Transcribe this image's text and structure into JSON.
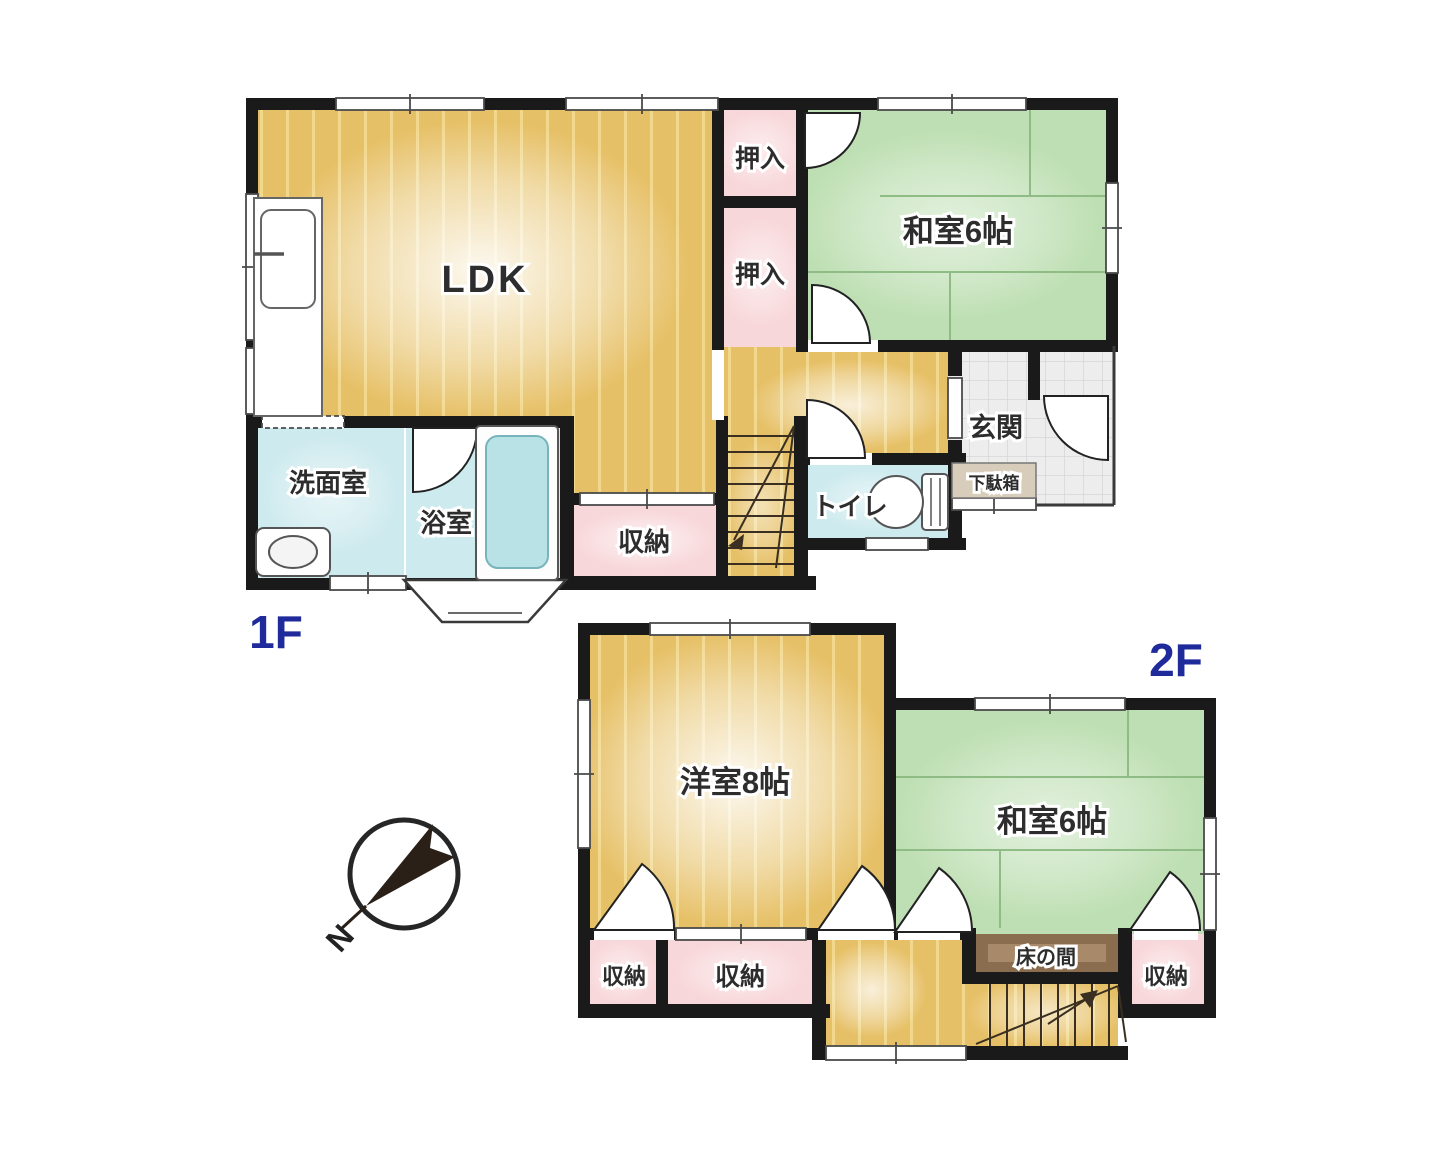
{
  "floors": {
    "f1": {
      "label": "1F",
      "rooms": {
        "ldk": "LDK",
        "oshiire_upper": "押入",
        "oshiire_lower": "押入",
        "washitsu": "和室6帖",
        "genkan": "玄関",
        "getabako": "下駄箱",
        "toilet": "トイレ",
        "storage": "収納",
        "bathroom": "浴室",
        "washroom": "洗面室"
      }
    },
    "f2": {
      "label": "2F",
      "rooms": {
        "yoshitsu": "洋室8帖",
        "washitsu": "和室6帖",
        "tokonoma": "床の間",
        "storage_left": "収納",
        "storage_mid": "収納",
        "storage_right": "収納"
      }
    }
  },
  "compass": {
    "north_label": "N"
  },
  "colors": {
    "wall": "#1a1a1a",
    "wood": "#e6c066",
    "wood_stripe": "#f2d88c",
    "tatami_green": "#bedfb3",
    "closet_pink": "#f8d7da",
    "water_teal": "#cdeaee",
    "tub_teal": "#b9e2e6",
    "tile_gray": "#ededed",
    "getabako_beige": "#d8cdbb",
    "tokonoma_brown": "#8a6c4e",
    "floor_label_navy": "#1f2a9b"
  }
}
